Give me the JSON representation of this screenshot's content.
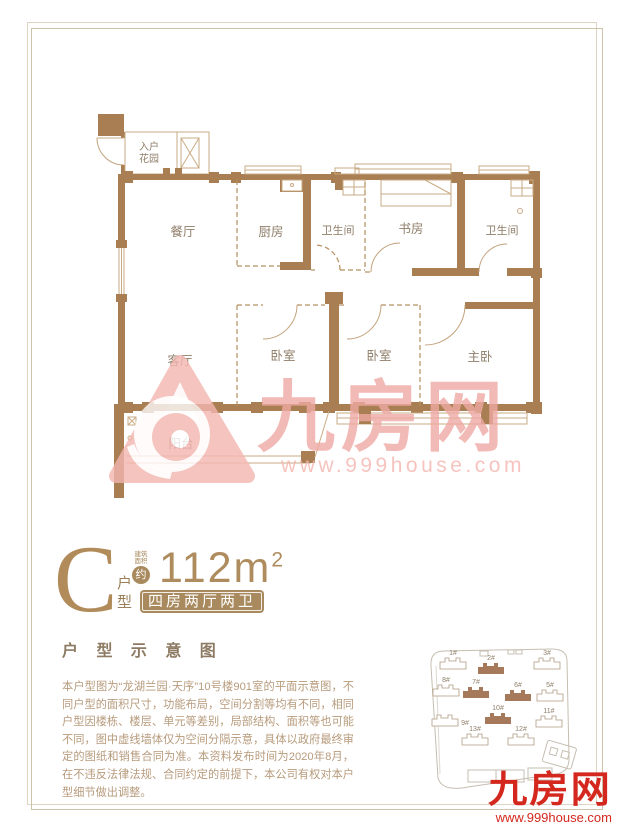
{
  "unit": {
    "letter": "C",
    "type_label": "户型",
    "area_note_l1": "建筑",
    "area_note_l2": "面积",
    "area_circle": "约",
    "area_value": "112m",
    "area_sup": "2",
    "tag": "四房两厅两卫"
  },
  "section_title": "户 型 示 意 图",
  "disclaimer": "本户型图为“龙湖兰园·天序”10号楼901室的平面示意图，不同户型的面积尺寸，功能布局，空间分割等均有不同，相同户型因楼栋、楼层、单元等差别，局部结构、面积等也可能不同，图中虚线墙体仅为空间分隔示意，具体以政府最终审定的图纸和销售合同为准。本资料发布时间为2020年8月，在不违反法律法规、合同约定的前提下，本公司有权对本户型细节做出调整。",
  "floor_plan": {
    "rooms": {
      "entry_garden_l1": "入户",
      "entry_garden_l2": "花园",
      "dining": "餐厅",
      "kitchen": "厨房",
      "bath1": "卫生间",
      "study": "书房",
      "bath2": "卫生间",
      "living": "客厅",
      "bedroom1": "卧室",
      "bedroom2": "卧室",
      "master": "主卧",
      "balcony": "阳台"
    }
  },
  "watermark": {
    "brand": "九房网",
    "url": "www.999house.com"
  },
  "site_plan": {
    "buildings": [
      {
        "label": "1#",
        "highlight": false
      },
      {
        "label": "2#",
        "highlight": true
      },
      {
        "label": "3#",
        "highlight": false
      },
      {
        "label": "8#",
        "highlight": false
      },
      {
        "label": "7#",
        "highlight": true
      },
      {
        "label": "6#",
        "highlight": true
      },
      {
        "label": "5#",
        "highlight": false
      },
      {
        "label": "9#",
        "highlight": false
      },
      {
        "label": "10#",
        "highlight": true
      },
      {
        "label": "11#",
        "highlight": false
      },
      {
        "label": "13#",
        "highlight": false
      },
      {
        "label": "12#",
        "highlight": false
      }
    ]
  },
  "footer_logo": {
    "brand": "九房网",
    "url": "www.999house.com"
  },
  "colors": {
    "wall_brown": "#a87e52",
    "accent_brown": "#a98a5e",
    "watermark_pink": "#f3b6b0",
    "brand_red": "#d4281f"
  }
}
